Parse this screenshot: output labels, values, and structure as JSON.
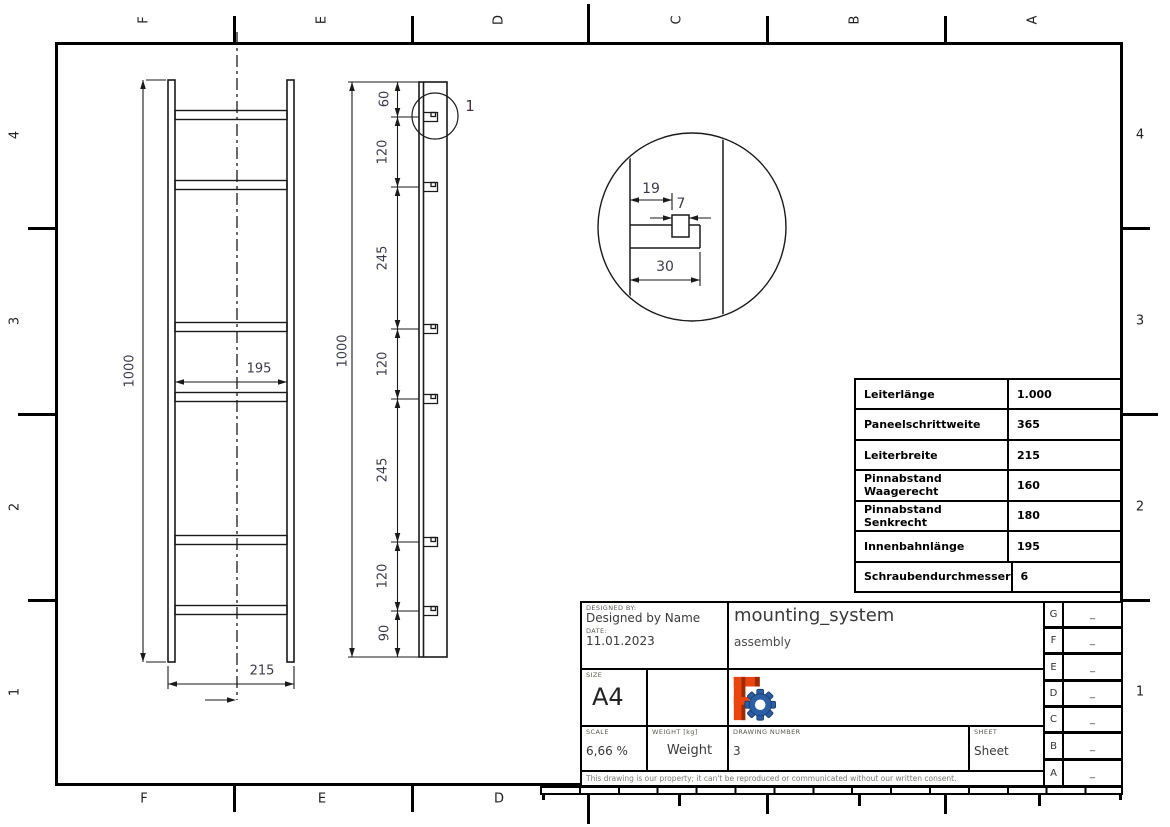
{
  "drawing_frame": {
    "top_labels": [
      "F",
      "E",
      "D",
      "C",
      "B",
      "A"
    ],
    "bottom_labels": [
      "F",
      "E",
      "D"
    ],
    "left_labels": [
      "4",
      "3",
      "2",
      "1"
    ],
    "right_labels": [
      "4",
      "3",
      "2",
      "1"
    ]
  },
  "front_view": {
    "overall_height": "1000",
    "inner_width": "195",
    "overall_width": "215"
  },
  "side_view": {
    "overall_height": "1000",
    "segments": [
      "60",
      "120",
      "245",
      "120",
      "245",
      "120",
      "90"
    ],
    "detail_callout": "1"
  },
  "detail_view": {
    "offset": "19",
    "pin_width": "7",
    "tab_width": "30"
  },
  "spec_table": {
    "rows": [
      {
        "label": "Leiterlänge",
        "value": "1.000"
      },
      {
        "label": "Paneelschrittweite",
        "value": "365"
      },
      {
        "label": "Leiterbreite",
        "value": "215"
      },
      {
        "label": "Pinnabstand Waagerecht",
        "value": "160"
      },
      {
        "label": "Pinnabstand Senkrecht",
        "value": "180"
      },
      {
        "label": "Innenbahnlänge",
        "value": "195"
      },
      {
        "label": "Schraubendurchmesser",
        "value": "6"
      }
    ]
  },
  "title_block": {
    "designed_by_label": "DESIGNED BY:",
    "designed_by": "Designed by Name",
    "date_label": "DATE:",
    "date": "11.01.2023",
    "size_label": "SIZE",
    "size": "A4",
    "title": "mounting_system",
    "subtitle": "assembly",
    "scale_label": "SCALE",
    "scale": "6,66 %",
    "weight_label": "WEIGHT [kg]",
    "weight": "Weight",
    "drawing_number_label": "DRAWING NUMBER",
    "drawing_number": "3",
    "sheet_label": "SHEET",
    "sheet": "Sheet",
    "disclaimer": "This drawing is our property; it can't be reproduced or communicated without our written consent.",
    "revisions": [
      {
        "letter": "G",
        "value": "_"
      },
      {
        "letter": "F",
        "value": "_"
      },
      {
        "letter": "E",
        "value": "_"
      },
      {
        "letter": "D",
        "value": "_"
      },
      {
        "letter": "C",
        "value": "_"
      },
      {
        "letter": "B",
        "value": "_"
      },
      {
        "letter": "A",
        "value": "_"
      }
    ]
  },
  "colors": {
    "line": "#1a1a1a",
    "dim_text": "#3b3b4e",
    "logo_f": "#e8450f",
    "logo_f_dark": "#9c2a05",
    "logo_gear": "#2b5fa3"
  }
}
